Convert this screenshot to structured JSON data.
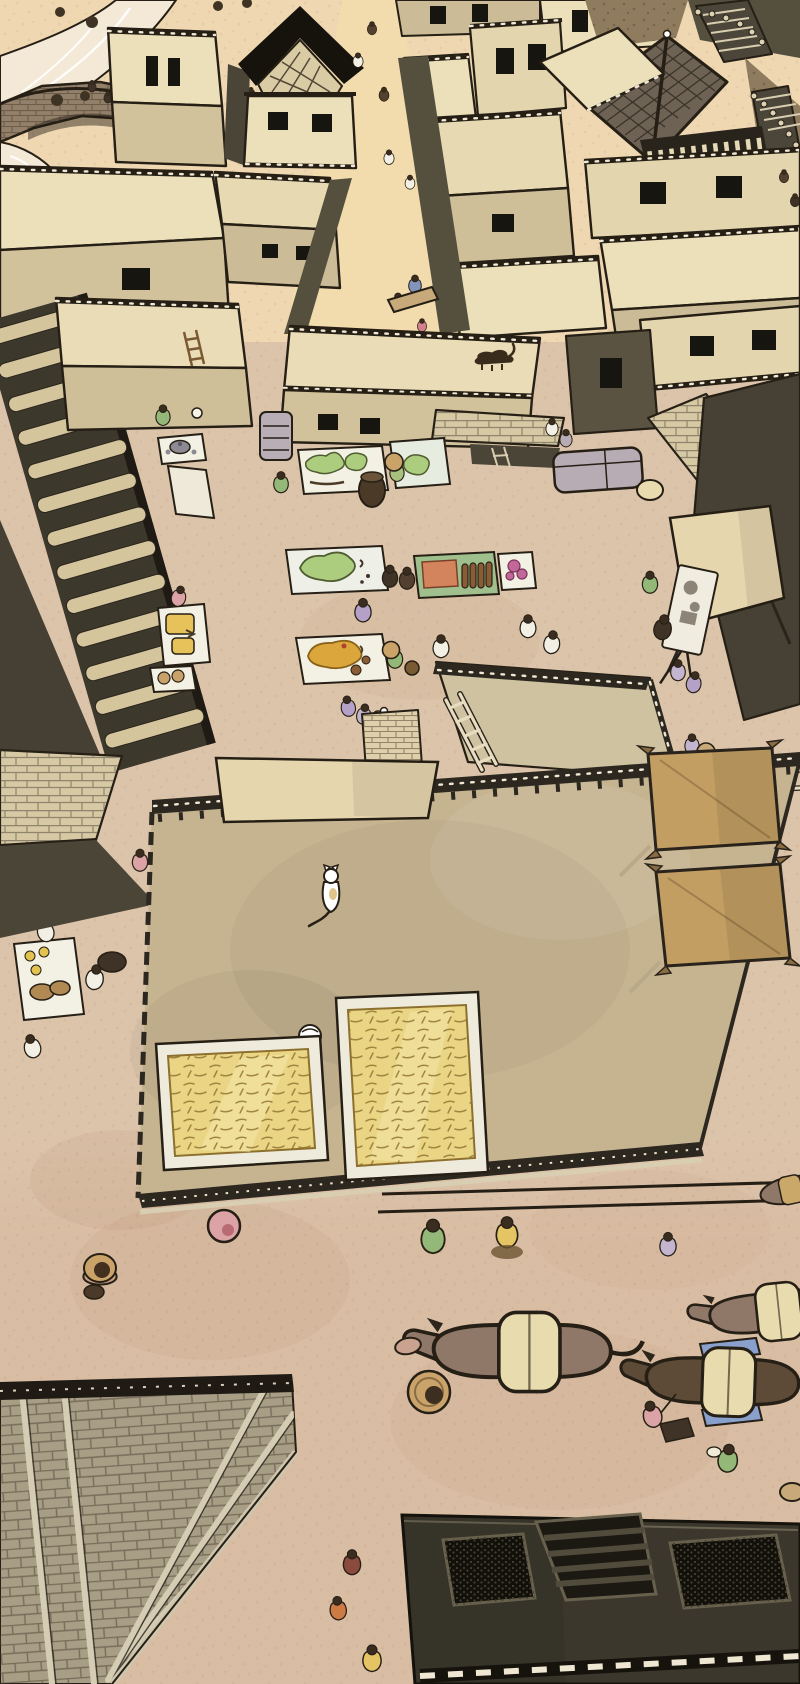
{
  "scene": {
    "type": "webtoon-illustration-panel",
    "description": "Aerial bird's-eye view of an ancient earthen town. A winding stream with a stone arch bridge sits at the top-left. Dense flat-roofed adobe buildings with dark window openings and one black gabled tower fill the upper half, split by a busy lane of tiny pedestrians. Below, an open market plaza holds vendor mats with green produce, orange cloth, jars and fruit, trays, baskets, a covered handcart and a canopy stall. A huge flat rooftop dominates the center with two straw drying mats, a white cat, a white bird, a leaning ladder and two large grain sacks at its edge. The lower ground shows pack donkeys led by handlers, scattered villagers, the corner of a large hip-tiled roof at bottom-left, and a dark flat warehouse roof with grated skylights and a slatted hatch at bottom-center.",
    "style": "manhwa / webtoon color line art, warm sepia palette, no text or UI",
    "view": "isometric top-down aerial",
    "time_of_day": "daytime"
  },
  "inventory": {
    "upper_town": {
      "stream": 1,
      "stone_arch_bridge": 1,
      "riverbank_trees": 8,
      "flat_roof_buildings": 16,
      "black_gabled_tower": 1,
      "tiled_pagoda_roof": 1,
      "rock_paths": 2,
      "staircases_with_railing_dots": 2,
      "street_pedestrians": 7,
      "pole_carriers": 2,
      "rooftop_figures": 2
    },
    "marketplace": {
      "vendor_mats": 8,
      "mat_goods": [
        "green produce",
        "orange cloth",
        "brown jars",
        "magenta textiles",
        "ochre fruit",
        "yellow wares",
        "tea set",
        "bread"
      ],
      "trays": 3,
      "round_baskets": 2,
      "dark_pot": 1,
      "covered_handcart": 1,
      "canopy_stall": 1,
      "display_board": 1,
      "vendors_and_shoppers": 22,
      "small_white_dog": 1,
      "dark_cat_on_roof": 1,
      "tiled_arcade_roof": 1
    },
    "large_rooftop": {
      "straw_drying_mats": 2,
      "white_cat": 1,
      "white_bird": 1,
      "rooftop_awning": 1,
      "long_ladder": 1,
      "brick_stair_block": 1,
      "grain_sacks": 2
    },
    "lower_plaza": {
      "pack_donkeys": 4,
      "donkey_handlers": 2,
      "round_carry_basket": 1,
      "clay_pot": 1,
      "straw_hat_villager": 1,
      "walking_villagers": 9
    },
    "bottom_structures": {
      "hip_tiled_roof_corner": 1,
      "dark_warehouse_roof": 1,
      "warehouse_skylights": 2,
      "warehouse_slatted_hatch": 1
    }
  },
  "palette": {
    "ink": "#261f15",
    "ground-base": "#dcc4ab",
    "ground-upper": "#eed7b1",
    "ground-lower": "#d8bca2",
    "street": "#f2dcae",
    "wall-light": "#ece0bb",
    "wall-cream": "#e3d5ae",
    "wall-mid": "#d2c29c",
    "wall-tan": "#cbbb96",
    "wall-shadow": "#55503e",
    "wall-dark": "#464134",
    "wall-olive": "#4b4538",
    "roof-dark-band": "#2c2820",
    "roof-black": "#16120c",
    "roof-mid": "#cfc2a0",
    "roof-big": "#c6b491",
    "tile-light": "#d6c9a4",
    "tile-strip": "#d4c59d",
    "tile-grey": "#6e6254",
    "brick": "#93806a",
    "rock": "#8f7b5e",
    "river": "#f3e9d6",
    "white-trim": "#f0e8d2",
    "mat-white": "#f3f0e4",
    "mat-blue": "#e6ecdf",
    "mat-green": "#9fbf8d",
    "veg-green": "#abcd7d",
    "cloth-orange": "#d4845c",
    "jar-brown": "#8a5c34",
    "item-magenta": "#c2679a",
    "item-ochre": "#dba73c",
    "tray-yellow": "#e7c159",
    "basket-gold": "#d9a94c",
    "canopy": "#e6d6ae",
    "cart-grey": "#b7abb4",
    "straw": "#e9d584",
    "straw-line": "#8d6f2e",
    "sack": "#c29e63",
    "pack": "#e8dcae",
    "blanket": "#8aa0cc",
    "donkey": "#8f7868",
    "donkey-dark": "#5d4a37",
    "cat-white": "#ffffff",
    "cat-dark": "#3a2c1c",
    "hair": "#3a2d1f",
    "skin": "#caa083",
    "hat-straw": "#c9a368",
    "cl-white": "#f2efe5",
    "cl-blue": "#8195bb",
    "cl-green": "#93b878",
    "cl-olive": "#a9bf7d",
    "cl-pink": "#dba3a6",
    "cl-rose": "#d2808c",
    "cl-purple": "#b5a0c8",
    "cl-lav": "#c3b4cf",
    "cl-brown": "#54402e",
    "cl-dbrown": "#3f3227",
    "cl-orange": "#cd7a45",
    "cl-yellow": "#e5c463",
    "cl-tan": "#c8a979",
    "cl-burg": "#8a4a3e"
  }
}
